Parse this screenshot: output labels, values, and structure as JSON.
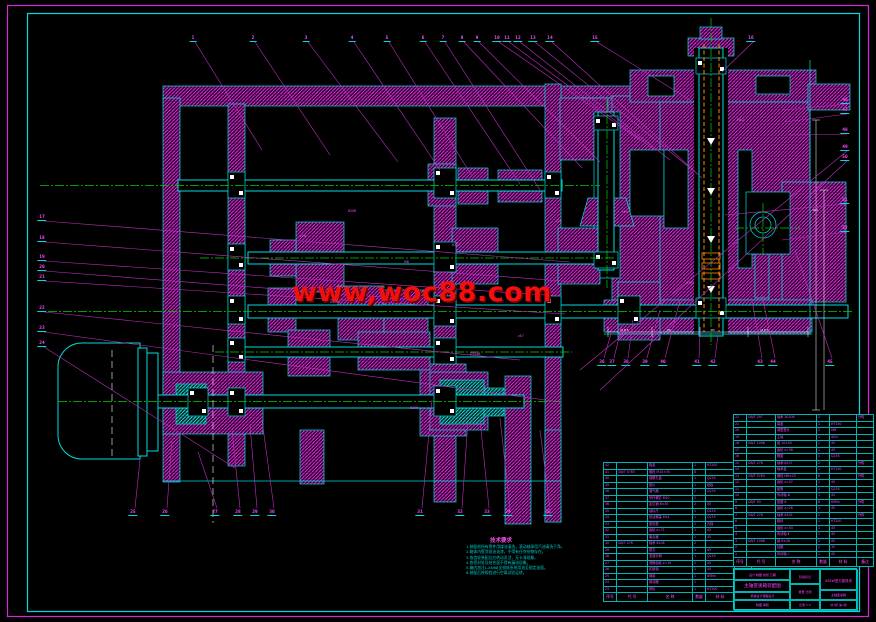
{
  "watermark": {
    "text": "www,woc88.com",
    "color": "#ff0000"
  },
  "notes": {
    "title": "技术要求",
    "lines": [
      "1.装配前所有零件用煤油清洗，滚动轴承用汽油清洗干净。",
      "2.箱体内壁涂耐油油漆，不得有任何杂物存在。",
      "3.各齿轮装配后应转动灵活，无卡滞现象。",
      "4.各密封处及结合面不得有漏油现象。",
      "5.箱内加注L-AN68全损耗系统用油至规定油面。",
      "6.装配后按规程进行空载试验运转。"
    ]
  },
  "callouts": {
    "top": [
      {
        "n": "1",
        "x": 193,
        "tx": 262,
        "ty": 150
      },
      {
        "n": "2",
        "x": 253,
        "tx": 330,
        "ty": 155
      },
      {
        "n": "3",
        "x": 306,
        "tx": 398,
        "ty": 162
      },
      {
        "n": "4",
        "x": 352,
        "tx": 440,
        "ty": 170
      },
      {
        "n": "5",
        "x": 387,
        "tx": 472,
        "ty": 176
      },
      {
        "n": "6",
        "x": 423,
        "tx": 520,
        "ty": 184
      },
      {
        "n": "7",
        "x": 443,
        "tx": 540,
        "ty": 190
      },
      {
        "n": "8",
        "x": 462,
        "tx": 582,
        "ty": 168
      },
      {
        "n": "9",
        "x": 477,
        "tx": 600,
        "ty": 162
      },
      {
        "n": "10",
        "x": 497,
        "tx": 640,
        "ty": 140
      },
      {
        "n": "11",
        "x": 507,
        "tx": 655,
        "ty": 150
      },
      {
        "n": "12",
        "x": 518,
        "tx": 670,
        "ty": 160
      },
      {
        "n": "13",
        "x": 533,
        "tx": 690,
        "ty": 168
      },
      {
        "n": "14",
        "x": 550,
        "tx": 702,
        "ty": 178
      },
      {
        "n": "15",
        "x": 595,
        "tx": 690,
        "ty": 100
      },
      {
        "n": "16",
        "x": 751,
        "tx": 722,
        "ty": 72
      }
    ],
    "left": [
      {
        "n": "17",
        "y": 215,
        "tx": 570,
        "ty": 262
      },
      {
        "n": "18",
        "y": 236,
        "tx": 575,
        "ty": 282
      },
      {
        "n": "19",
        "y": 255,
        "tx": 560,
        "ty": 296
      },
      {
        "n": "20",
        "y": 265,
        "tx": 420,
        "ty": 300
      },
      {
        "n": "21",
        "y": 275,
        "tx": 565,
        "ty": 314
      },
      {
        "n": "22",
        "y": 306,
        "tx": 520,
        "ty": 360
      },
      {
        "n": "23",
        "y": 326,
        "tx": 560,
        "ty": 402
      },
      {
        "n": "24",
        "y": 341,
        "tx": 235,
        "ty": 468
      }
    ],
    "bottom": [
      {
        "n": "25",
        "x": 133,
        "tx": 140,
        "ty": 460
      },
      {
        "n": "26",
        "x": 165,
        "tx": 172,
        "ty": 440
      },
      {
        "n": "27",
        "x": 215,
        "tx": 198,
        "ty": 452
      },
      {
        "n": "28",
        "x": 238,
        "tx": 232,
        "ty": 430
      },
      {
        "n": "29",
        "x": 255,
        "tx": 250,
        "ty": 425
      },
      {
        "n": "30",
        "x": 272,
        "tx": 262,
        "ty": 420
      },
      {
        "n": "31",
        "x": 420,
        "tx": 432,
        "ty": 400
      },
      {
        "n": "32",
        "x": 460,
        "tx": 468,
        "ty": 420
      },
      {
        "n": "33",
        "x": 487,
        "tx": 480,
        "ty": 420
      },
      {
        "n": "34",
        "x": 508,
        "tx": 500,
        "ty": 418
      },
      {
        "n": "35",
        "x": 548,
        "tx": 540,
        "ty": 430
      }
    ],
    "right_mid": [
      {
        "n": "36",
        "x": 602,
        "tx": 612,
        "ty": 330
      },
      {
        "n": "37",
        "x": 612,
        "tx": 622,
        "ty": 325
      },
      {
        "n": "38",
        "x": 626,
        "tx": 633,
        "ty": 320
      },
      {
        "n": "39",
        "x": 645,
        "tx": 660,
        "ty": 310
      },
      {
        "n": "40",
        "x": 663,
        "tx": 680,
        "ty": 300
      },
      {
        "n": "41",
        "x": 697,
        "tx": 700,
        "ty": 330
      },
      {
        "n": "42",
        "x": 713,
        "tx": 718,
        "ty": 335
      },
      {
        "n": "43",
        "x": 760,
        "tx": 752,
        "ty": 300
      },
      {
        "n": "44",
        "x": 773,
        "tx": 762,
        "ty": 295
      },
      {
        "n": "45",
        "x": 830,
        "tx": 795,
        "ty": 250
      }
    ],
    "right_edge": [
      {
        "n": "46",
        "y": 98,
        "tx": 783,
        "ty": 110
      },
      {
        "n": "47",
        "y": 108,
        "tx": 785,
        "ty": 122
      },
      {
        "n": "48",
        "y": 128,
        "tx": 790,
        "ty": 135
      },
      {
        "n": "49",
        "y": 145,
        "tx": 580,
        "ty": 370
      },
      {
        "n": "50",
        "y": 155,
        "tx": 600,
        "ty": 390
      },
      {
        "n": "51",
        "y": 198,
        "tx": 725,
        "ty": 215
      },
      {
        "n": "52",
        "y": 226,
        "tx": 782,
        "ty": 240
      }
    ]
  },
  "bom_right": {
    "headers": [
      "序号",
      "代  号",
      "名  称",
      "数量",
      "材  料",
      "备注"
    ],
    "rows": [
      [
        "22",
        "GB/T 297",
        "轴承 30206",
        "2",
        "",
        "外购"
      ],
      [
        "21",
        "",
        "端盖",
        "1",
        "HT150",
        ""
      ],
      [
        "20",
        "",
        "调整垫片",
        "2",
        "08F",
        ""
      ],
      [
        "19",
        "",
        "主轴",
        "1",
        "40Cr",
        ""
      ],
      [
        "18",
        "GB/T 1096",
        "键 10×50",
        "1",
        "45",
        ""
      ],
      [
        "17",
        "",
        "齿轮 z=38",
        "1",
        "45",
        ""
      ],
      [
        "16",
        "",
        "隔套",
        "1",
        "Q235",
        ""
      ],
      [
        "15",
        "GB/T 276",
        "轴承 6207",
        "2",
        "",
        "外购"
      ],
      [
        "14",
        "",
        "轴承盖",
        "1",
        "HT150",
        ""
      ],
      [
        "13",
        "GB/T 5783",
        "螺栓 M8×25",
        "6",
        "",
        "外购"
      ],
      [
        "12",
        "",
        "齿轮 z=47",
        "1",
        "45",
        ""
      ],
      [
        "11",
        "",
        "套筒",
        "1",
        "Q235",
        ""
      ],
      [
        "10",
        "",
        "传动轴 Ⅲ",
        "1",
        "45",
        ""
      ],
      [
        "9",
        "GB/T 93",
        "垫圈 8",
        "6",
        "65Mn",
        "外购"
      ],
      [
        "8",
        "",
        "齿轮 z=26",
        "1",
        "45",
        ""
      ],
      [
        "7",
        "GB/T 276",
        "轴承 6305",
        "2",
        "",
        "外购"
      ],
      [
        "6",
        "",
        "箱体",
        "1",
        "HT200",
        ""
      ],
      [
        "5",
        "",
        "齿轮 z=54",
        "1",
        "45",
        ""
      ],
      [
        "4",
        "",
        "传动轴 Ⅱ",
        "1",
        "45",
        ""
      ],
      [
        "3",
        "GB/T 1096",
        "键 6×28",
        "2",
        "45",
        ""
      ],
      [
        "2",
        "",
        "挡圈",
        "2",
        "35",
        ""
      ],
      [
        "1",
        "",
        "传动轴 Ⅰ",
        "1",
        "45",
        ""
      ]
    ]
  },
  "bom_left": {
    "headers": [
      "序号",
      "代  号",
      "名  称",
      "数量",
      "材  料",
      "备注"
    ],
    "rows": [
      [
        "42",
        "",
        "箱盖",
        "1",
        "HT200",
        ""
      ],
      [
        "41",
        "GB/T 5783",
        "螺栓 M10×35",
        "8",
        "",
        "外购"
      ],
      [
        "40",
        "",
        "观察孔盖",
        "1",
        "Q235",
        ""
      ],
      [
        "39",
        "",
        "垫片",
        "1",
        "纸板",
        ""
      ],
      [
        "38",
        "",
        "通气器",
        "1",
        "Q235",
        ""
      ],
      [
        "37",
        "",
        "吊环螺钉 M10",
        "2",
        "",
        "外购"
      ],
      [
        "36",
        "",
        "定位销 8×30",
        "2",
        "35",
        ""
      ],
      [
        "35",
        "",
        "油标尺",
        "1",
        "Q235",
        ""
      ],
      [
        "34",
        "",
        "放油螺塞 M14",
        "1",
        "Q235",
        ""
      ],
      [
        "33",
        "",
        "密封垫",
        "1",
        "石棉",
        ""
      ],
      [
        "32",
        "",
        "齿轮 z=71",
        "1",
        "45",
        ""
      ],
      [
        "31",
        "",
        "离合器",
        "1",
        "45",
        ""
      ],
      [
        "30",
        "GB/T 276",
        "轴承 6208",
        "2",
        "",
        "外购"
      ],
      [
        "29",
        "",
        "拨叉",
        "1",
        "45",
        ""
      ],
      [
        "28",
        "",
        "变速手柄",
        "1",
        "Q235",
        ""
      ],
      [
        "27",
        "",
        "滑移齿轮 z=19",
        "1",
        "45",
        ""
      ],
      [
        "26",
        "",
        "花键轴",
        "1",
        "45",
        ""
      ],
      [
        "25",
        "",
        "弹簧",
        "1",
        "65Mn",
        ""
      ],
      [
        "24",
        "",
        "制动器",
        "1",
        "",
        ""
      ],
      [
        "23",
        "",
        "带轮",
        "1",
        "HT200",
        ""
      ]
    ]
  },
  "title_block": {
    "cells": [
      "设计 制图 校核 日期",
      "主轴变速箱装配图",
      "机械设计课程设计",
      "制图    审核",
      "阶段标记",
      "重量  比例",
      "比例 1:2",
      "X62W型万能铣床",
      "主轴变速箱",
      "共1张 第1张"
    ]
  },
  "inline_labels": [
    {
      "t": "6206",
      "x": 348,
      "y": 209
    },
    {
      "t": "z38",
      "x": 300,
      "y": 234
    },
    {
      "t": "M8",
      "x": 404,
      "y": 260
    },
    {
      "t": "6207",
      "x": 452,
      "y": 243
    },
    {
      "t": "z47",
      "x": 518,
      "y": 334
    },
    {
      "t": "6305",
      "x": 686,
      "y": 281
    },
    {
      "t": "6306",
      "x": 410,
      "y": 406
    },
    {
      "t": "z26",
      "x": 556,
      "y": 219
    },
    {
      "t": "z54",
      "x": 622,
      "y": 210
    },
    {
      "t": "M12",
      "x": 737,
      "y": 118
    },
    {
      "t": "Ø40k6",
      "x": 330,
      "y": 300
    },
    {
      "t": "Ø35k6",
      "x": 470,
      "y": 352
    }
  ],
  "dim_labels": [
    {
      "t": "118.5",
      "x": 620,
      "y": 328
    },
    {
      "t": "86",
      "x": 667,
      "y": 328
    },
    {
      "t": "95",
      "x": 711,
      "y": 328
    },
    {
      "t": "118.5",
      "x": 760,
      "y": 328
    },
    {
      "t": "460",
      "x": 812,
      "y": 208
    }
  ]
}
